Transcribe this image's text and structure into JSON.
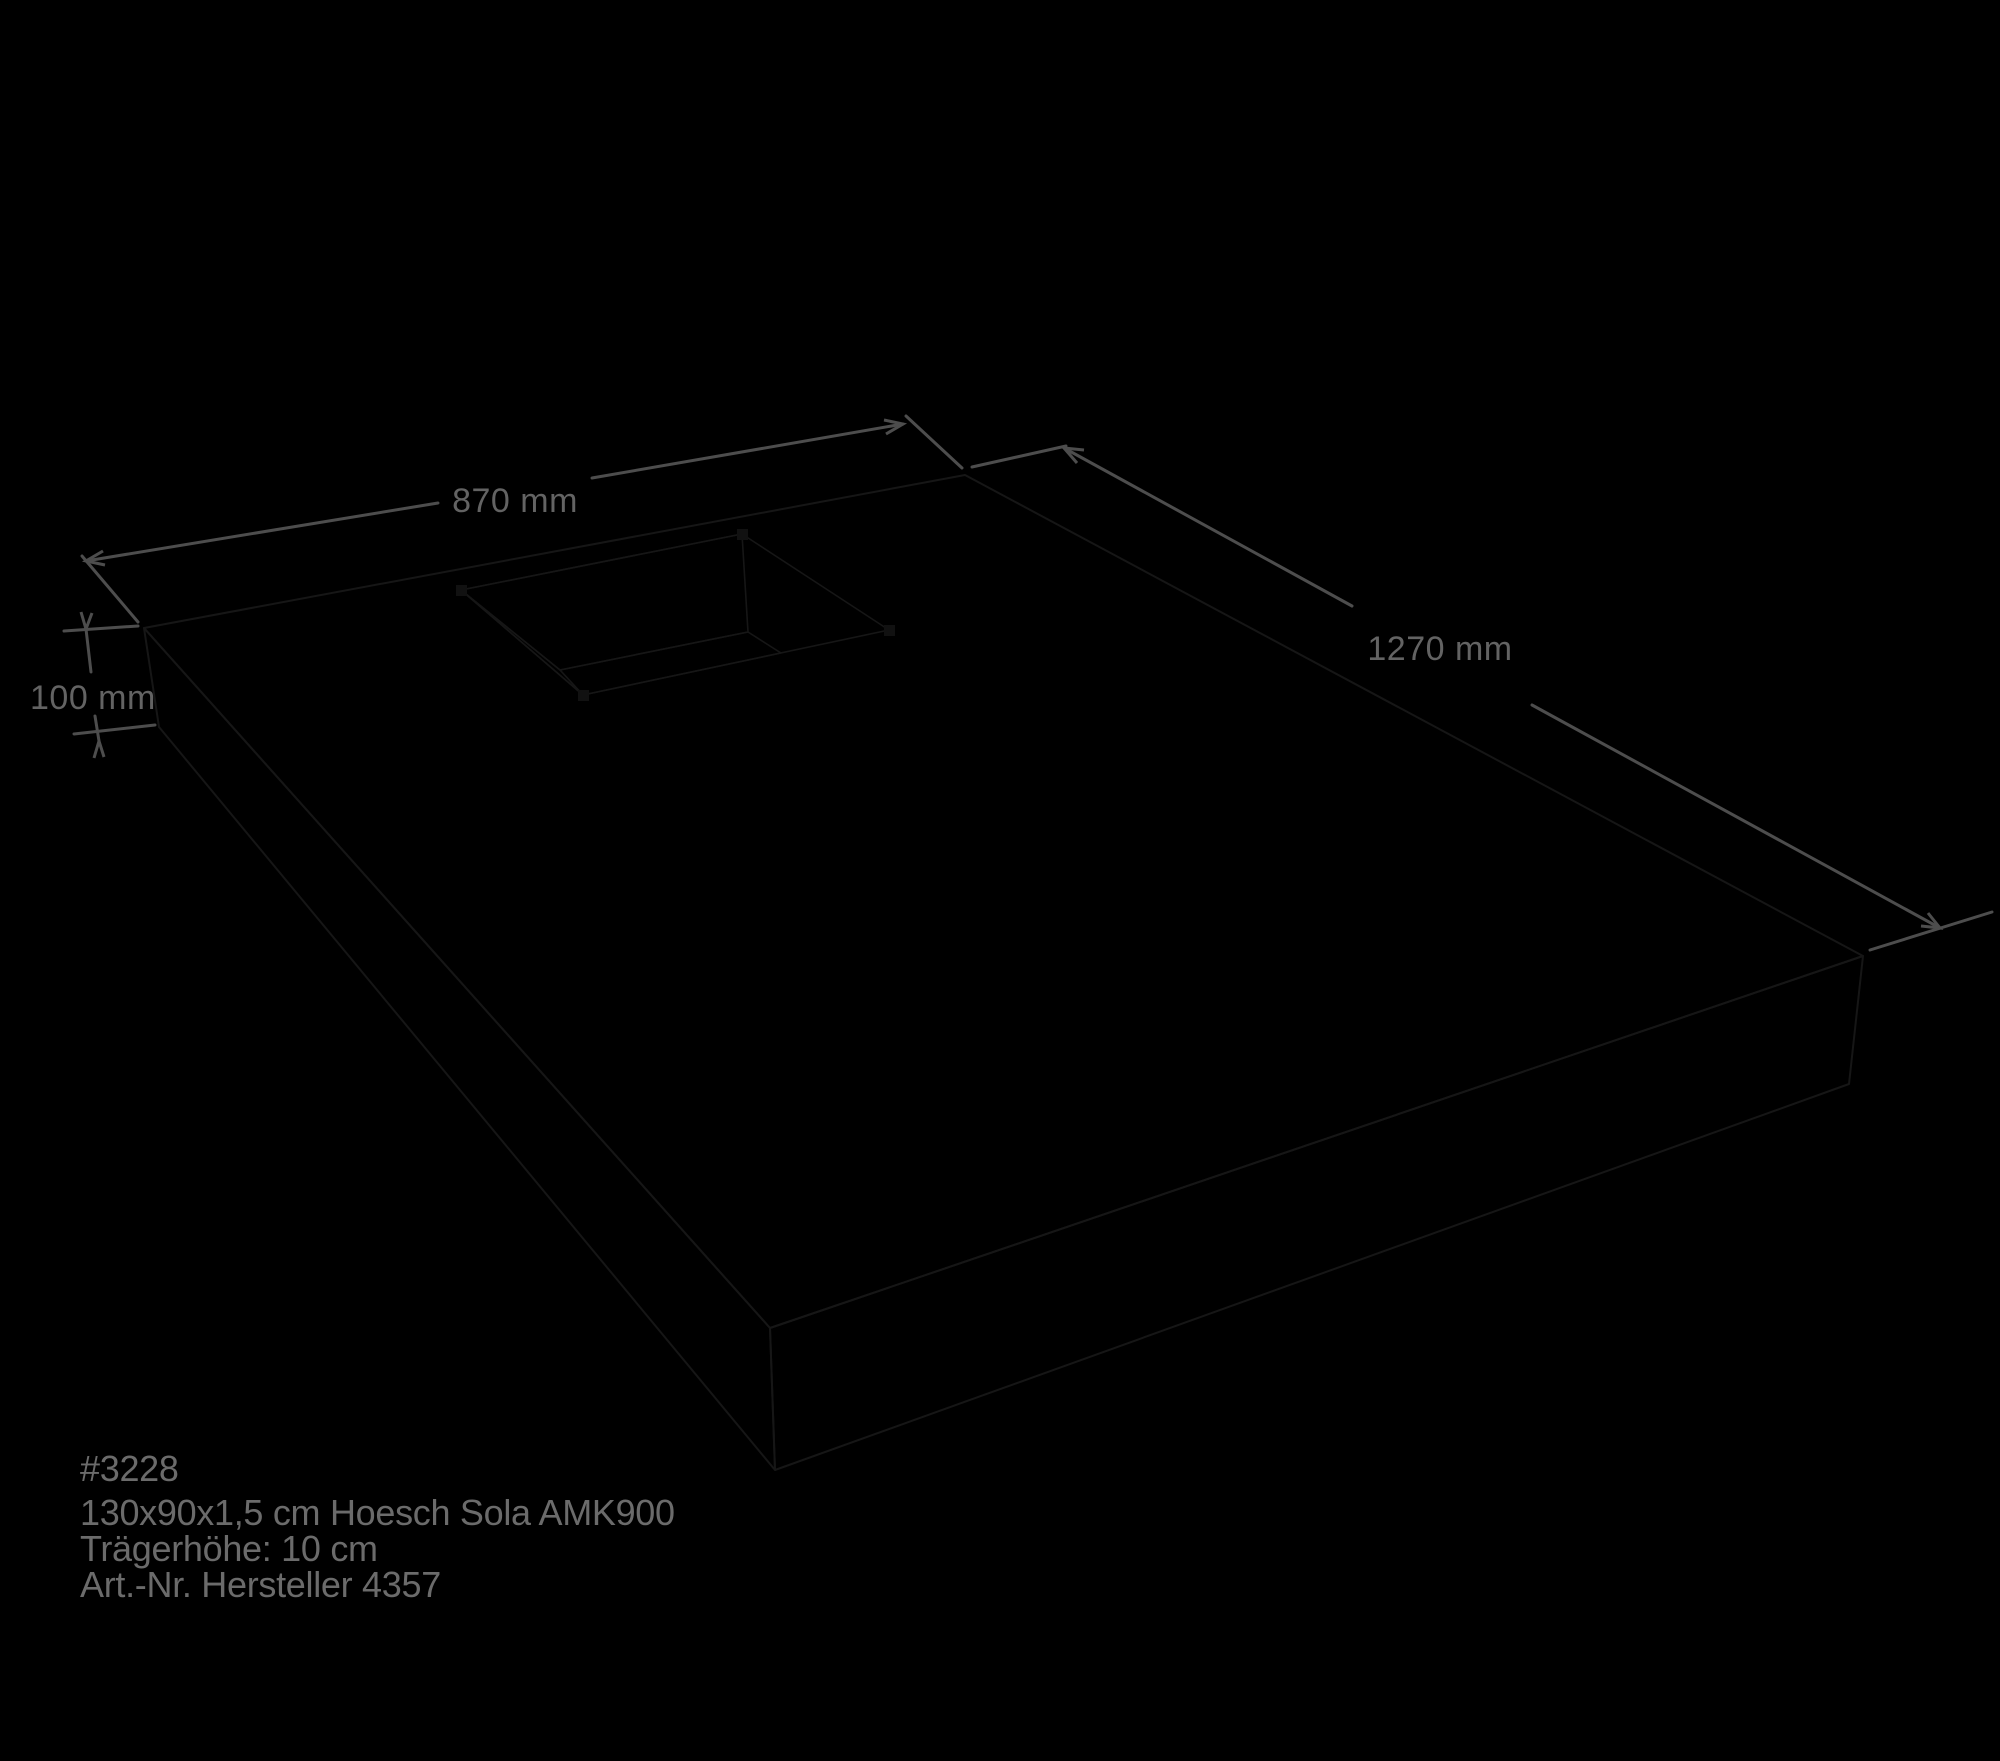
{
  "scene": {
    "background": "#000000",
    "colors": {
      "top_face": "#c9c9c9",
      "front_left_face": "#cbcbcb",
      "front_right_face": "#fdfdfd",
      "hole_far_wall": "#ffffff",
      "hole_side_wall": "#f4f4f4",
      "hole_floor": "#0c0c0c",
      "edge_line": "#161616",
      "dimension_line": "#4d4d4d",
      "dimension_text": "#636363",
      "info_text": "#6b6b6b",
      "corner_marker": "#111111"
    }
  },
  "dimensions": {
    "width": {
      "label": "870 mm"
    },
    "length": {
      "label": "1270 mm"
    },
    "height": {
      "label": "100 mm"
    }
  },
  "product_info": {
    "lines": [
      "#3228",
      "130x90x1,5 cm Hoesch Sola AMK900",
      "Trägerhöhe: 10 cm",
      "Art.-Nr. Hersteller 4357"
    ]
  }
}
